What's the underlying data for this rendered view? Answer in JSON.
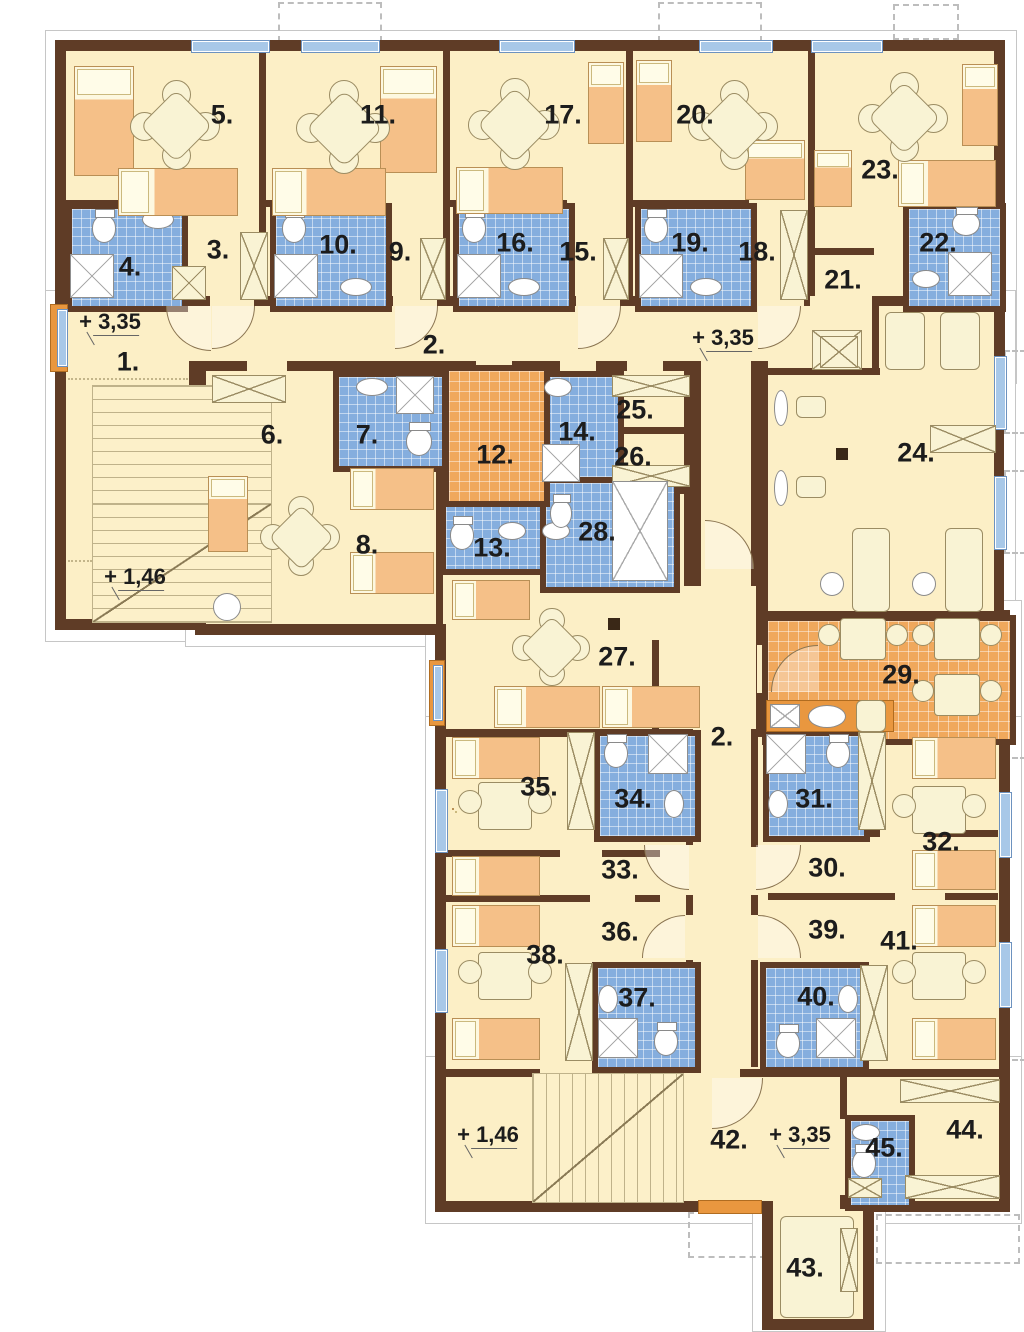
{
  "plan": {
    "type": "floor-plan",
    "rooms": [
      {
        "label": "1."
      },
      {
        "label": "2."
      },
      {
        "label": "3."
      },
      {
        "label": "4."
      },
      {
        "label": "5."
      },
      {
        "label": "6."
      },
      {
        "label": "7."
      },
      {
        "label": "8."
      },
      {
        "label": "9."
      },
      {
        "label": "10."
      },
      {
        "label": "11."
      },
      {
        "label": "12."
      },
      {
        "label": "13."
      },
      {
        "label": "14."
      },
      {
        "label": "15."
      },
      {
        "label": "16."
      },
      {
        "label": "17."
      },
      {
        "label": "18."
      },
      {
        "label": "19."
      },
      {
        "label": "20."
      },
      {
        "label": "21."
      },
      {
        "label": "22."
      },
      {
        "label": "23."
      },
      {
        "label": "24."
      },
      {
        "label": "25."
      },
      {
        "label": "26."
      },
      {
        "label": "27."
      },
      {
        "label": "28."
      },
      {
        "label": "29."
      },
      {
        "label": "30."
      },
      {
        "label": "31."
      },
      {
        "label": "32."
      },
      {
        "label": "33."
      },
      {
        "label": "34."
      },
      {
        "label": "35."
      },
      {
        "label": "36."
      },
      {
        "label": "37."
      },
      {
        "label": "38."
      },
      {
        "label": "39."
      },
      {
        "label": "40."
      },
      {
        "label": "41."
      },
      {
        "label": "42."
      },
      {
        "label": "43."
      },
      {
        "label": "44."
      },
      {
        "label": "45."
      }
    ],
    "markers": [
      {
        "label": "+ 3,35"
      },
      {
        "label": "+ 3,35"
      },
      {
        "label": "+ 1,46"
      },
      {
        "label": "+ 1,46"
      },
      {
        "label": "+ 3,35"
      }
    ],
    "colors": {
      "wall": "#5f3c26",
      "floor": "#fcefc6",
      "tile_blue": "#85aede",
      "tile_orange": "#f0a85c",
      "window": "#a8c8e8",
      "accent_orange": "#e9973f",
      "bed": "#f5c088",
      "furn": "#f9f3d4"
    }
  }
}
